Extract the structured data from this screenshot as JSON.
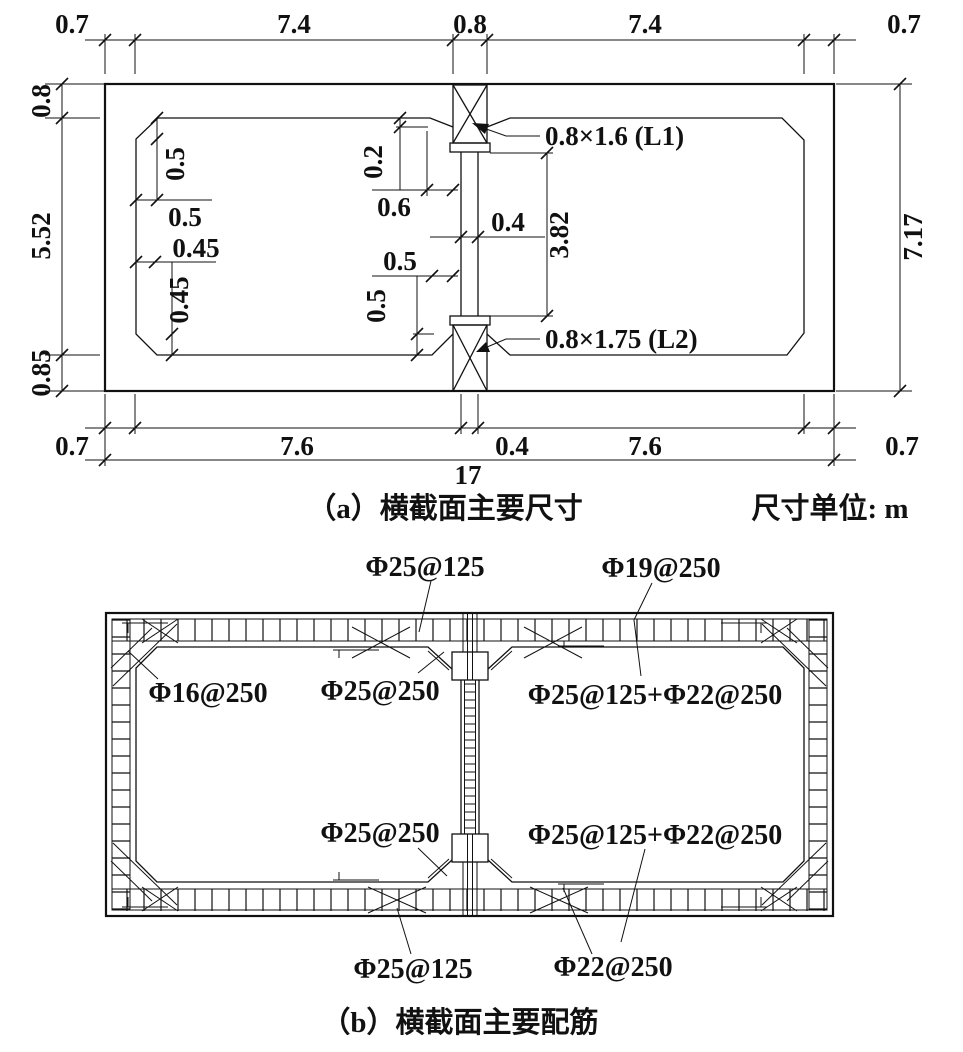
{
  "panel_a": {
    "caption": "（a）横截面主要尺寸",
    "unit_note": "尺寸单位: m",
    "top_dims": [
      "0.7",
      "7.4",
      "0.8",
      "7.4",
      "0.7"
    ],
    "bottom_dims": [
      "0.7",
      "7.6",
      "0.4",
      "7.6",
      "0.7"
    ],
    "total_width_dim": "17",
    "left_dims": [
      "0.8",
      "5.52",
      "0.85"
    ],
    "right_dim": "7.17",
    "inner_dims": {
      "top_left_chamfer_v": "0.5",
      "top_left_chamfer_h": "0.5",
      "bottom_left_chamfer_h": "0.45",
      "bottom_left_chamfer_v": "0.45",
      "top_haunch_depth": "0.2",
      "top_haunch_width": "0.6",
      "mid_wall_thickness": "0.4",
      "mid_wall_clear_height": "3.82",
      "bottom_haunch_width": "0.5",
      "bottom_haunch_depth": "0.5"
    },
    "beam_labels": {
      "l1": "0.8×1.6 (L1)",
      "l2": "0.8×1.75 (L2)"
    }
  },
  "panel_b": {
    "caption": "（b）横截面主要配筋",
    "rebar_labels": {
      "top_slab_top": "Φ25@125",
      "top_slab_distribution": "Φ19@250",
      "side_wall": "Φ16@250",
      "top_haunch": "Φ25@250",
      "right_cell_top": "Φ25@125+Φ22@250",
      "bottom_haunch": "Φ25@250",
      "right_cell_bottom": "Φ25@125+Φ22@250",
      "bottom_slab_bottom": "Φ25@125",
      "bottom_slab_distribution": "Φ22@250"
    }
  }
}
